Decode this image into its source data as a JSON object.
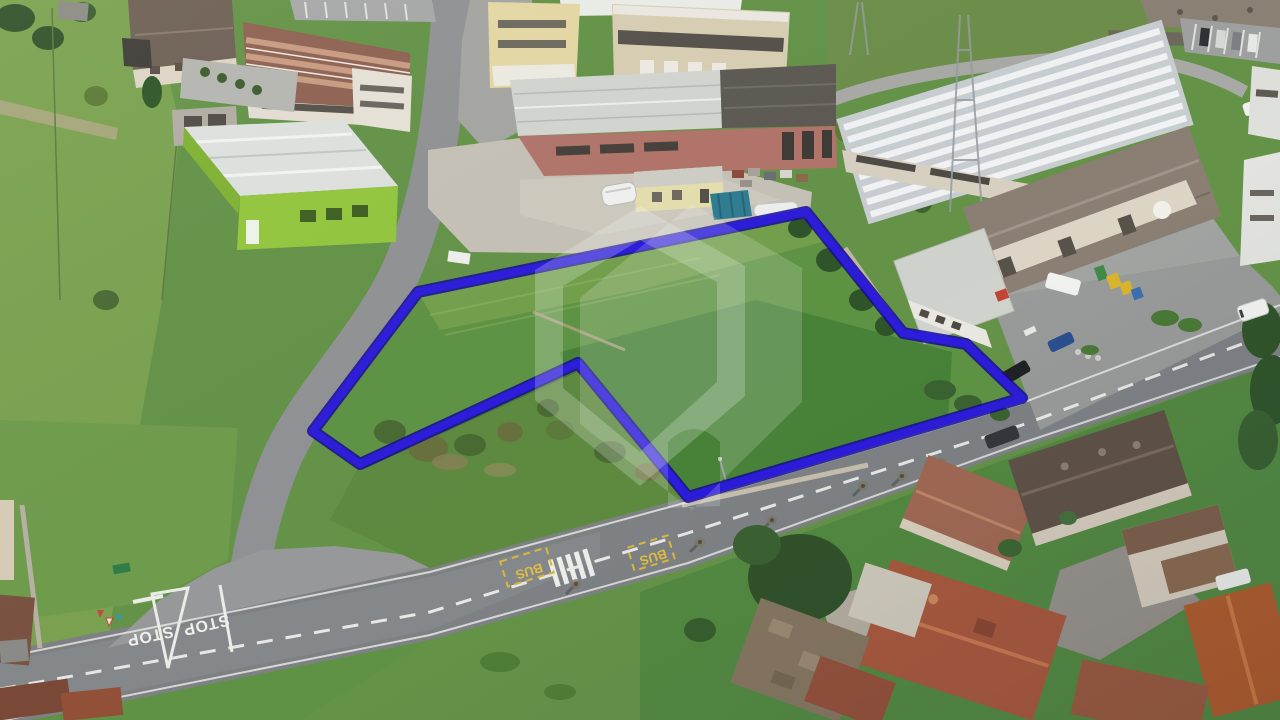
{
  "image": {
    "kind": "aerial drone photograph",
    "subject": "Building land parcel outlined in blue beside a road junction, industrial sheds above, village houses with tiled roofs below right"
  },
  "parcel": {
    "outline_points": "806,212 903,333 966,344 1022,398 688,497 578,363 360,464 313,431 418,292",
    "outline_color": "#2c1cdb",
    "outline_edge_color": "#150a96"
  },
  "watermark": {
    "color": "#ffffff",
    "ring_path": "M640,206 L745,266 L745,396 L640,486 L535,400 L535,270 Z M640,240 L717,282 L717,382 L640,452 L563,388 L563,286 Z",
    "solid_path": "M692,204 L802,268 L802,402 L692,510 L580,424 L580,298 Z M668,508 L668,442 Q694,416 720,442 L720,506 Z"
  },
  "road_markings": {
    "stop": [
      "STOP",
      "STOP"
    ],
    "bus": [
      "BUS",
      "BUS"
    ],
    "stop_color": "#f2f2ec",
    "bus_color": "#e2bf3e"
  }
}
